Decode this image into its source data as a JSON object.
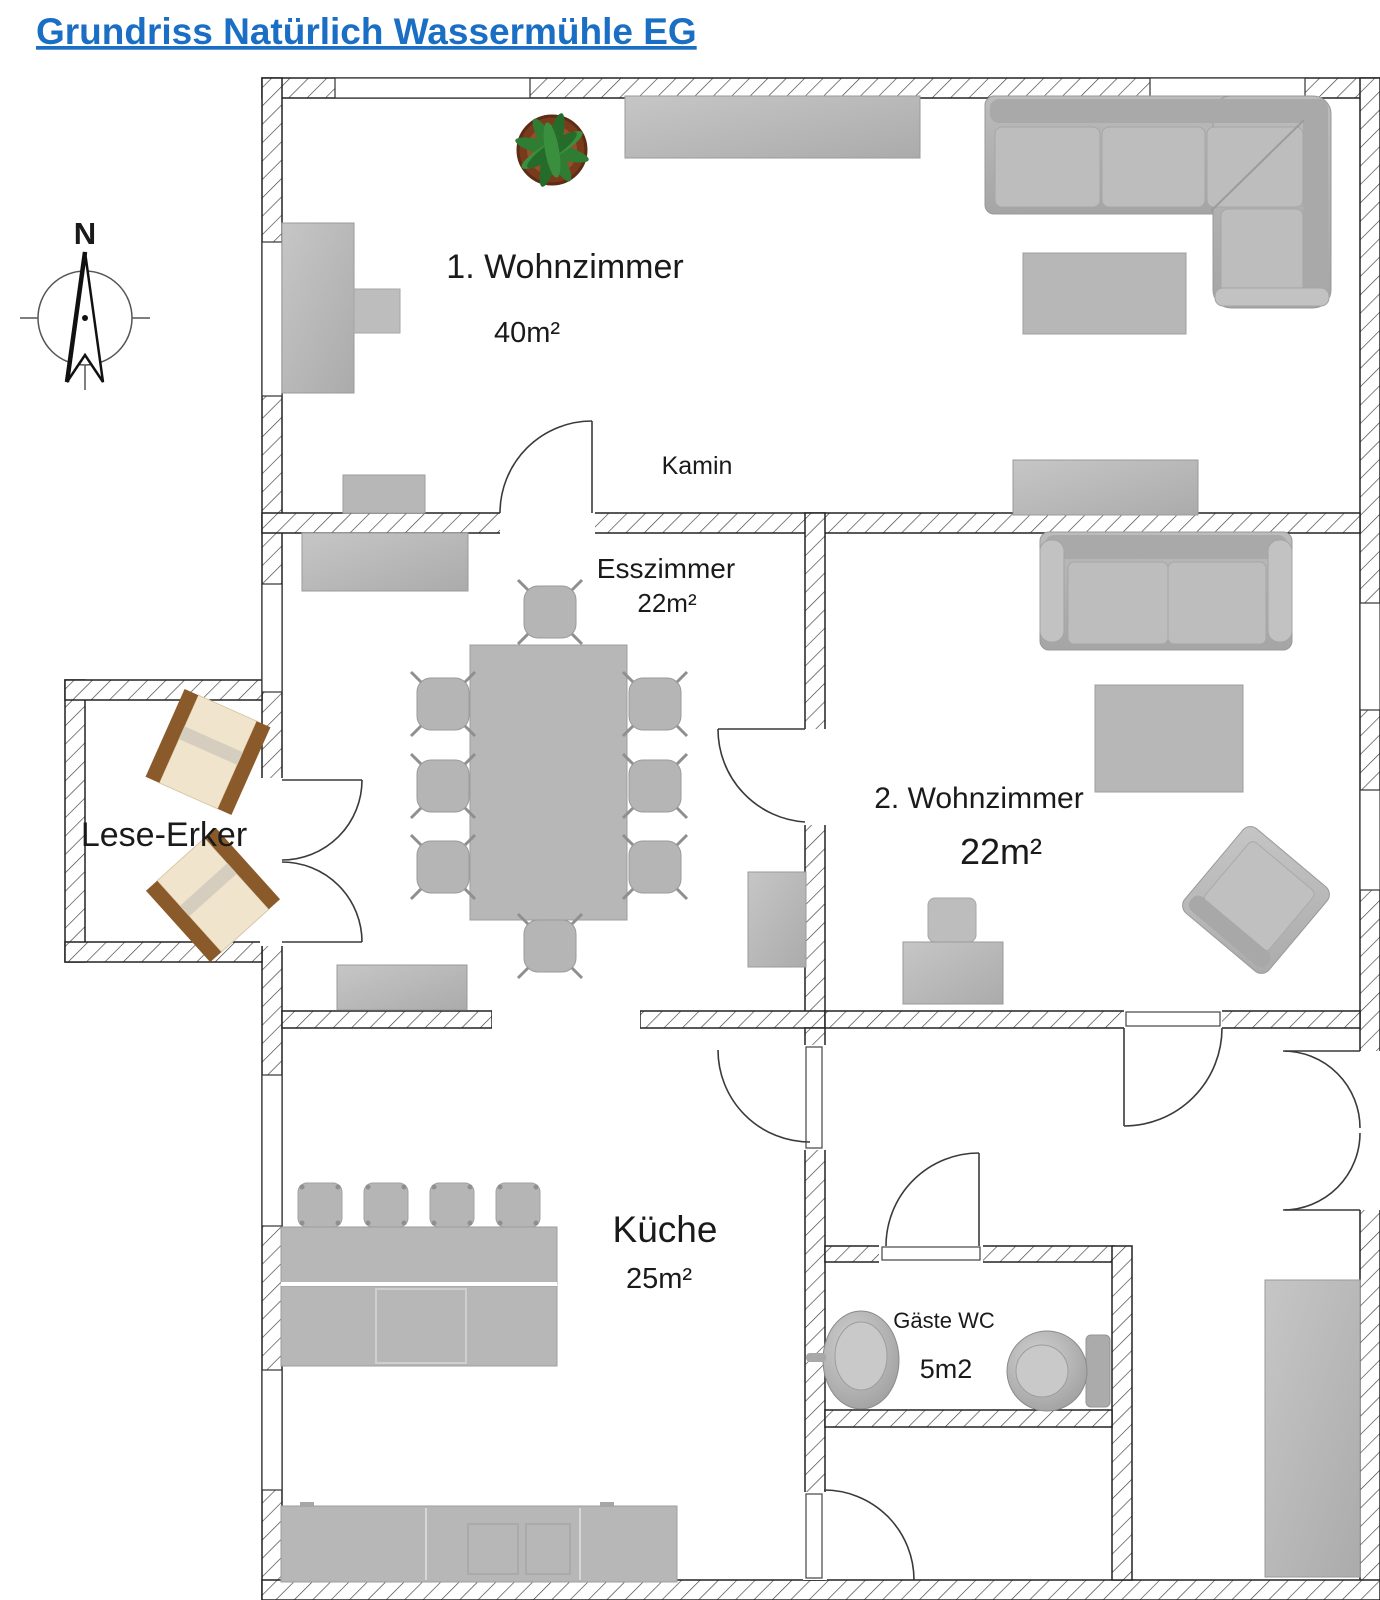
{
  "title": {
    "text": "Grundriss Natürlich Wassermühle EG",
    "color": "#1a6fc4"
  },
  "compass": {
    "north": "N"
  },
  "rooms": {
    "wohnzimmer1": {
      "name": "1. Wohnzimmer",
      "area": "40m²"
    },
    "esszimmer": {
      "name": "Esszimmer",
      "area": "22m²"
    },
    "wohnzimmer2": {
      "name": "2. Wohnzimmer",
      "area": "22m²"
    },
    "kueche": {
      "name": "Küche",
      "area": "25m²"
    },
    "gaeste_wc": {
      "name": "Gäste WC",
      "area": "5m2"
    },
    "lese_erker": {
      "name": "Lese-Erker"
    }
  },
  "labels": {
    "kamin": "Kamin"
  },
  "colors": {
    "wall_outline": "#222222",
    "furniture_gray": "#b7b7b7",
    "wood_brown": "#8b5a2b",
    "chair_beige": "#f0e4cc",
    "plant_green": "#2f7d33",
    "pot_brown": "#7a3b1d"
  }
}
